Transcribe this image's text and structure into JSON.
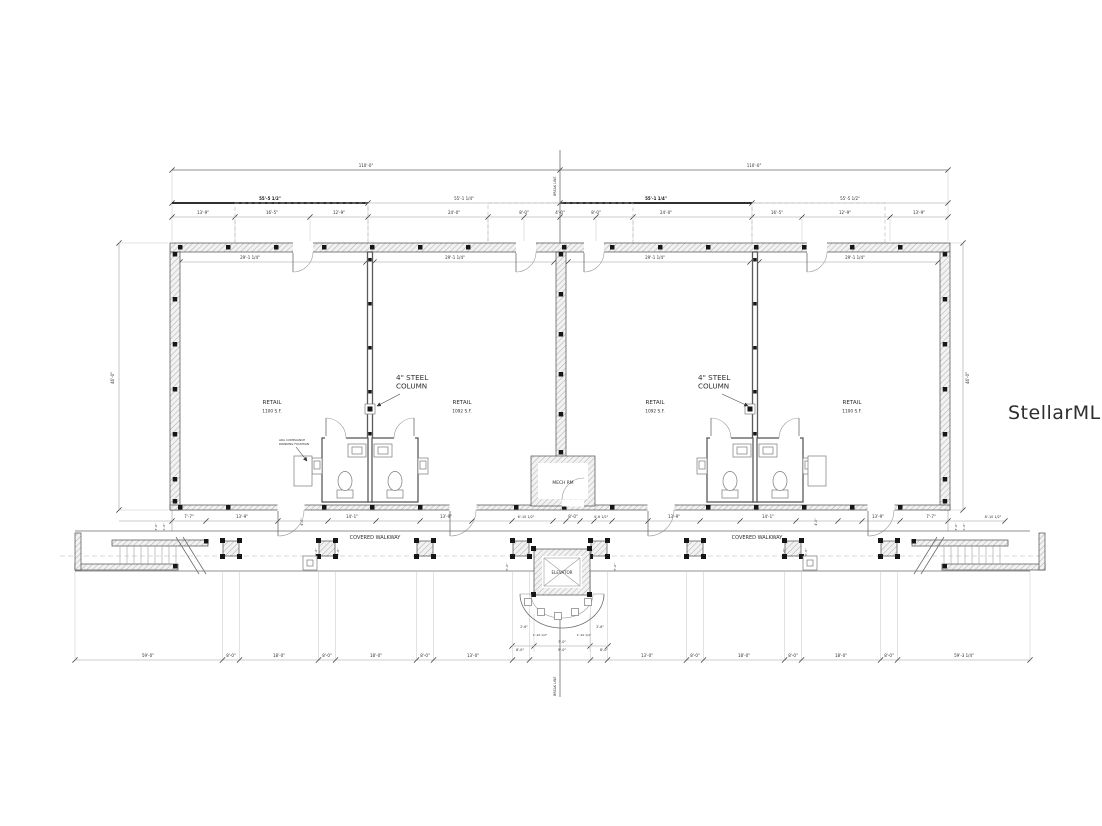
{
  "page": {
    "background": "#ffffff",
    "line_color": "#6e6e6e",
    "ink_color": "#161616",
    "watermark_color": "#d5d5d5"
  },
  "plan": {
    "break_line_top": "BREAK LINE",
    "break_line_bottom": "BREAK LINE",
    "watermark": "StellarMLS",
    "mech_room_label": "MECH RM",
    "elevator_label": "ELEVATOR",
    "rooms": [
      {
        "label": "RETAIL",
        "area": "1100 S.F.",
        "cx": 272,
        "cy": 404
      },
      {
        "label": "RETAIL",
        "area": "1092 S.F.",
        "cx": 462,
        "cy": 404
      },
      {
        "label": "RETAIL",
        "area": "1092 S.F.",
        "cx": 655,
        "cy": 404
      },
      {
        "label": "RETAIL",
        "area": "1100 S.F.",
        "cx": 852,
        "cy": 404
      }
    ],
    "covered_walkway": [
      {
        "text": "COVERED WALKWAY",
        "cx": 375,
        "cy": 539
      },
      {
        "text": "COVERED WALKWAY",
        "cx": 757,
        "cy": 539
      }
    ],
    "callouts": [
      {
        "lines": [
          "4\" STEEL",
          "COLUMN"
        ],
        "x": 396,
        "y": 380,
        "size": 7.2,
        "leader": [
          400,
          394,
          377,
          406
        ]
      },
      {
        "lines": [
          "4\" STEEL",
          "COLUMN"
        ],
        "x": 698,
        "y": 380,
        "size": 7.2,
        "leader": [
          722,
          394,
          748,
          406
        ]
      },
      {
        "lines": [
          "ADA COMPLIANCE",
          "DRINKING FOUNTAIN"
        ],
        "x": 279,
        "y": 441,
        "size": 2.9,
        "leader": [
          296,
          447,
          307,
          461
        ]
      }
    ],
    "dim_labels": [
      {
        "t": "110'-0\"",
        "x": 366,
        "y": 167
      },
      {
        "t": "110'-0\"",
        "x": 754,
        "y": 167
      },
      {
        "t": "55'-5 1/2\"",
        "x": 270,
        "y": 200,
        "b": 1
      },
      {
        "t": "55'-1 1/4\"",
        "x": 464,
        "y": 200
      },
      {
        "t": "55'-1 1/4\"",
        "x": 656,
        "y": 200,
        "b": 1
      },
      {
        "t": "55'-5 1/2\"",
        "x": 850,
        "y": 200
      },
      {
        "t": "13'-9\"",
        "x": 203,
        "y": 214
      },
      {
        "t": "16'-5\"",
        "x": 272,
        "y": 214
      },
      {
        "t": "12'-9\"",
        "x": 339,
        "y": 214
      },
      {
        "t": "24'-0\"",
        "x": 454,
        "y": 214
      },
      {
        "t": "8'-0\"",
        "x": 524,
        "y": 214
      },
      {
        "t": "4'-0\"",
        "x": 560,
        "y": 214
      },
      {
        "t": "8'-0\"",
        "x": 596,
        "y": 214
      },
      {
        "t": "24'-0\"",
        "x": 666,
        "y": 214
      },
      {
        "t": "16'-5\"",
        "x": 777,
        "y": 214
      },
      {
        "t": "12'-9\"",
        "x": 845,
        "y": 214
      },
      {
        "t": "13'-9\"",
        "x": 919,
        "y": 214
      },
      {
        "t": "29'-1 1/4\"",
        "x": 250,
        "y": 259
      },
      {
        "t": "29'-1 1/4\"",
        "x": 455,
        "y": 259
      },
      {
        "t": "29'-1 1/4\"",
        "x": 655,
        "y": 259
      },
      {
        "t": "29'-1 1/4\"",
        "x": 855,
        "y": 259
      },
      {
        "t": "46'-0\"",
        "x": 114,
        "y": 378,
        "r": -90
      },
      {
        "t": "46'-0\"",
        "x": 969,
        "y": 378,
        "r": -90
      },
      {
        "t": "7'-7\"",
        "x": 189,
        "y": 518
      },
      {
        "t": "13'-9\"",
        "x": 242,
        "y": 518
      },
      {
        "t": "4'-0\"",
        "x": 303,
        "y": 522,
        "r": -90,
        "s": 3.1
      },
      {
        "t": "14'-1\"",
        "x": 352,
        "y": 518
      },
      {
        "t": "13'-9\"",
        "x": 446,
        "y": 518
      },
      {
        "t": "6'-10 1/2\"",
        "x": 526,
        "y": 518,
        "s": 3.4
      },
      {
        "t": "8'-0\"",
        "x": 573,
        "y": 518
      },
      {
        "t": "4'-6 1/2\"",
        "x": 601,
        "y": 518,
        "s": 3.4
      },
      {
        "t": "13'-9\"",
        "x": 674,
        "y": 518
      },
      {
        "t": "14'-1\"",
        "x": 768,
        "y": 518
      },
      {
        "t": "4'-0\"",
        "x": 817,
        "y": 522,
        "r": -90,
        "s": 3.1
      },
      {
        "t": "13'-9\"",
        "x": 878,
        "y": 518
      },
      {
        "t": "7'-7\"",
        "x": 931,
        "y": 518
      },
      {
        "t": "8'-10 1/2\"",
        "x": 993,
        "y": 518,
        "s": 3.4
      },
      {
        "t": "3'-0\"",
        "x": 157,
        "y": 527,
        "r": -90,
        "s": 3
      },
      {
        "t": "1'-6\"",
        "x": 165,
        "y": 527,
        "r": -90,
        "s": 3
      },
      {
        "t": "3'-0\"",
        "x": 957,
        "y": 527,
        "r": -90,
        "s": 3
      },
      {
        "t": "1'-6\"",
        "x": 965,
        "y": 527,
        "r": -90,
        "s": 3
      },
      {
        "t": "5'-0\"",
        "x": 317,
        "y": 552,
        "r": -90,
        "s": 3
      },
      {
        "t": "5'-0\"",
        "x": 339,
        "y": 552,
        "r": -90,
        "s": 3
      },
      {
        "t": "5'-0\"",
        "x": 785,
        "y": 552,
        "r": -90,
        "s": 3
      },
      {
        "t": "5'-0\"",
        "x": 807,
        "y": 552,
        "r": -90,
        "s": 3
      },
      {
        "t": "5'-0\"",
        "x": 508,
        "y": 567,
        "r": -90,
        "s": 3
      },
      {
        "t": "5'-0\"",
        "x": 616,
        "y": 567,
        "r": -90,
        "s": 3
      },
      {
        "t": "2'-6\"",
        "x": 524,
        "y": 628,
        "s": 3.2
      },
      {
        "t": "2'-6\"",
        "x": 600,
        "y": 628,
        "s": 3.2
      },
      {
        "t": "1'-10 1/2\"",
        "x": 540,
        "y": 636,
        "s": 3
      },
      {
        "t": "1'-10 1/2\"",
        "x": 584,
        "y": 636,
        "s": 3
      },
      {
        "t": "7'-0\"",
        "x": 562,
        "y": 643,
        "s": 3.4
      },
      {
        "t": "8'-0\"",
        "x": 520,
        "y": 651,
        "s": 3.4
      },
      {
        "t": "9'-0\"",
        "x": 562,
        "y": 651,
        "s": 3.4
      },
      {
        "t": "8'-0\"",
        "x": 604,
        "y": 651,
        "s": 3.4
      },
      {
        "t": "59'-0\"",
        "x": 148,
        "y": 657
      },
      {
        "t": "8'-0\"",
        "x": 231,
        "y": 657
      },
      {
        "t": "18'-0\"",
        "x": 279,
        "y": 657
      },
      {
        "t": "8'-0\"",
        "x": 327,
        "y": 657
      },
      {
        "t": "18'-0\"",
        "x": 376,
        "y": 657
      },
      {
        "t": "8'-0\"",
        "x": 425,
        "y": 657
      },
      {
        "t": "13'-0\"",
        "x": 473,
        "y": 657
      },
      {
        "t": "13'-0\"",
        "x": 647,
        "y": 657
      },
      {
        "t": "8'-0\"",
        "x": 695,
        "y": 657
      },
      {
        "t": "18'-0\"",
        "x": 744,
        "y": 657
      },
      {
        "t": "8'-0\"",
        "x": 793,
        "y": 657
      },
      {
        "t": "18'-0\"",
        "x": 841,
        "y": 657
      },
      {
        "t": "8'-0\"",
        "x": 889,
        "y": 657
      },
      {
        "t": "59'-3 1/4\"",
        "x": 964,
        "y": 657
      }
    ]
  }
}
